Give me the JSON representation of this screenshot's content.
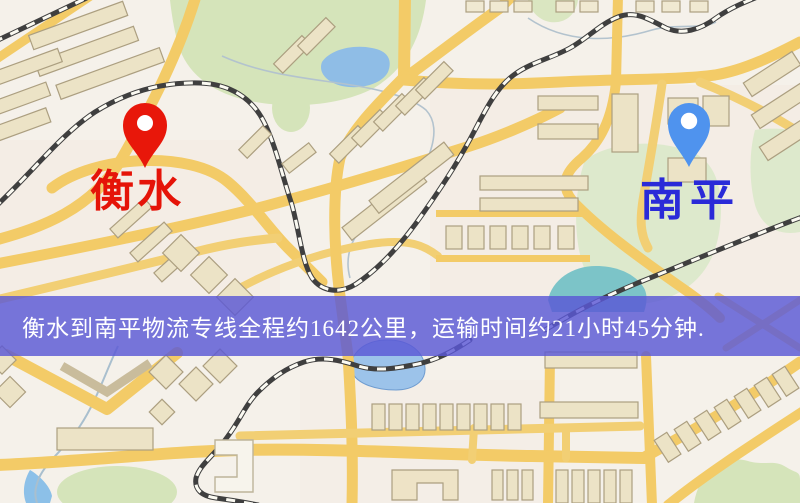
{
  "map": {
    "type": "logistics-route-map",
    "origin": {
      "name": "衡水",
      "pin_color": "#e8170a",
      "label_color": "#e51408"
    },
    "destination": {
      "name": "南平",
      "pin_color": "#4f93ee",
      "label_color": "#2a2ad8"
    },
    "banner": {
      "text": "衡水到南平物流专线全程约1642公里，运输时间约21小时45分钟.",
      "background_color": "#5a58d6",
      "text_color": "#ffffff"
    },
    "route": {
      "distance_km": "1642",
      "duration": "21小时45分钟"
    },
    "palette": {
      "land": "#f5f1ea",
      "road_yellow": "#f3cb67",
      "park_green": "#d5e4ba",
      "water_blue": "#8fbde6",
      "railway_dark": "#3f3f3f",
      "building_fill": "#ece3c6"
    }
  }
}
